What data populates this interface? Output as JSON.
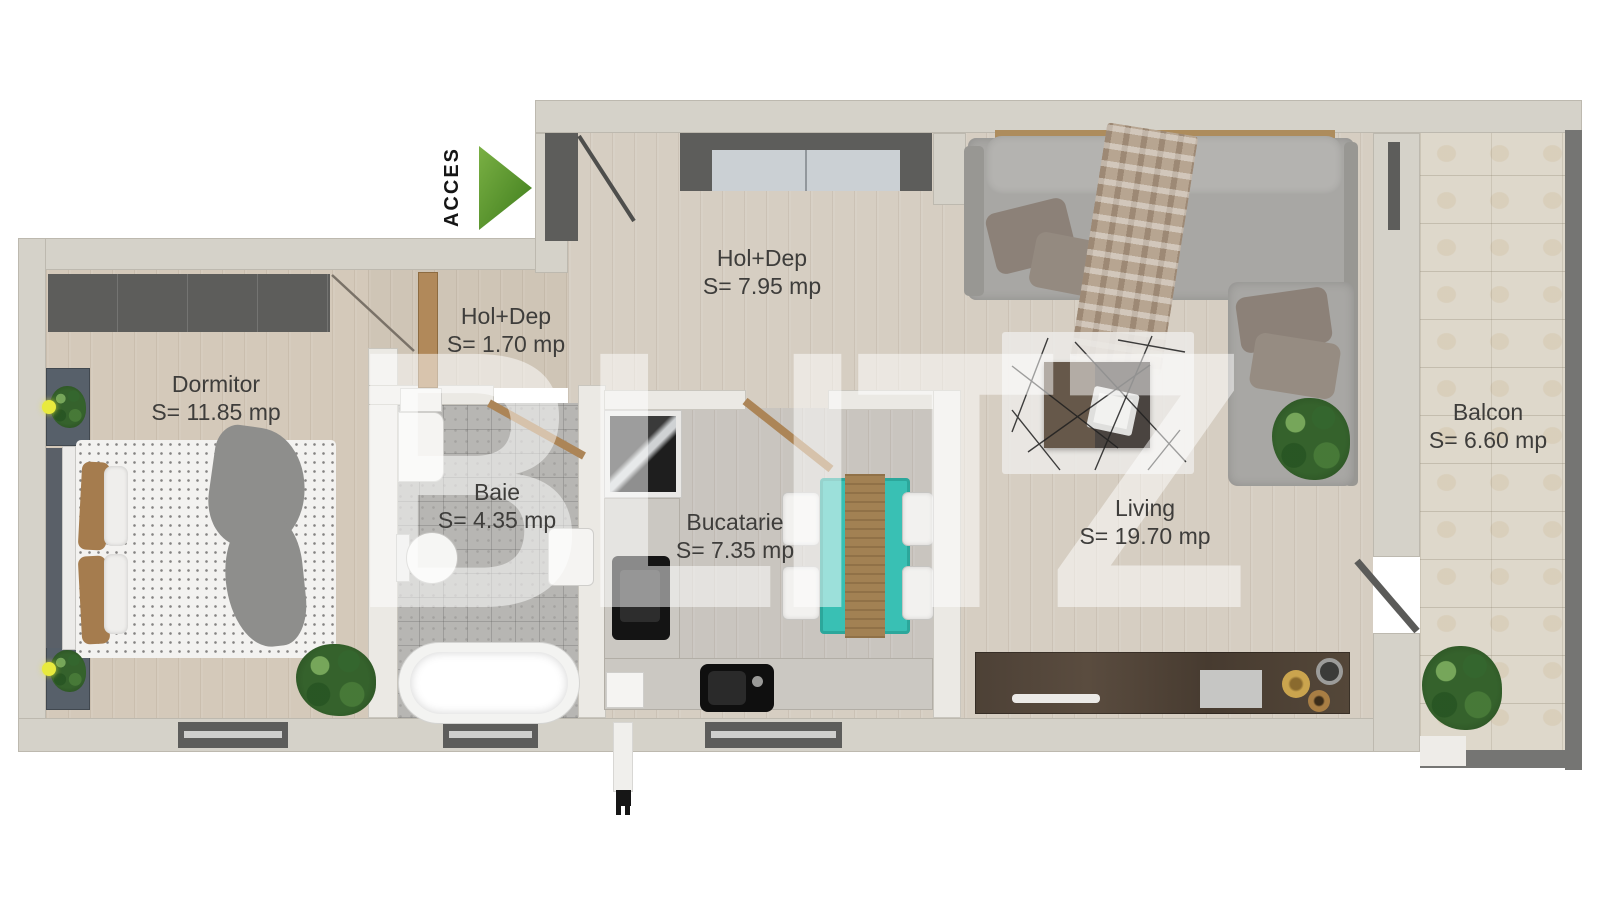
{
  "watermark": "BLITZ",
  "access": {
    "label": "ACCES"
  },
  "rooms": {
    "dormitor": {
      "name": "Dormitor",
      "area": "S= 11.85 mp"
    },
    "hol_dep_mic": {
      "name": "Hol+Dep",
      "area": "S= 1.70 mp"
    },
    "hol_dep_mare": {
      "name": "Hol+Dep",
      "area": "S= 7.95 mp"
    },
    "baie": {
      "name": "Baie",
      "area": "S= 4.35 mp"
    },
    "bucatarie": {
      "name": "Bucatarie",
      "area": "S= 7.35 mp"
    },
    "living": {
      "name": "Living",
      "area": "S= 19.70 mp"
    },
    "balcon": {
      "name": "Balcon",
      "area": "S= 6.60 mp"
    }
  },
  "colors": {
    "accent_green": "#4e8f27",
    "wall_beige": "#d5d2c9",
    "fixture_dark_gray": "#5d5d5b",
    "dining_table_teal": "#39c0b4"
  }
}
